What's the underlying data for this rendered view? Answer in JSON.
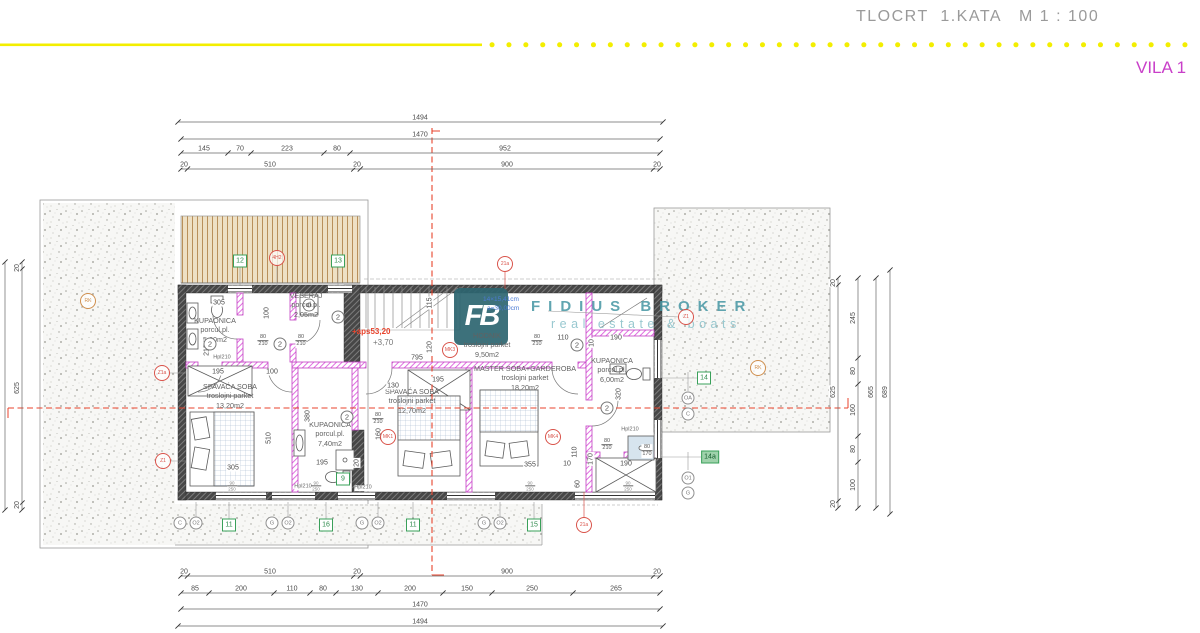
{
  "header": {
    "title": "TLOCRT  1.KATA   M 1 : 100",
    "vila": "VILA 1"
  },
  "colors": {
    "accent_yellow": "#f3ee00",
    "vila_magenta": "#c93fc9",
    "centerline_red": "#e8432c",
    "logo_teal": "#2d6570",
    "brand_teal": "#4596a3",
    "tagline_teal": "#94c6ce",
    "mark_green": "#3aa05a",
    "mark_red": "#d9534a",
    "mark_orange": "#cf8f4e",
    "wall_magenta": "#c23fc2",
    "stair_blue": "#4a7ad4",
    "title_gray": "#9a9a9a"
  },
  "watermark": {
    "logo": "FB",
    "brand": "FIDIUS BROKER",
    "tagline": "real estate & boats"
  },
  "plan": {
    "levels": {
      "abs": "+aps53,20",
      "rel": "+3,70"
    },
    "stairs": {
      "riser": "14×15,41cm",
      "tread": "a=30,00cm"
    },
    "rooms": [
      {
        "name": "KUPAONICA",
        "finish": "porcul.pl.",
        "area": "5,30m2",
        "x": 215,
        "y": 316
      },
      {
        "name": "VEŠERAJ",
        "finish": "porcul.pl.",
        "area": "2,05m2",
        "x": 306,
        "y": 291
      },
      {
        "name": "HODNIK",
        "finish": "troslojni parket",
        "area": "9,50m2",
        "x": 487,
        "y": 331
      },
      {
        "name": "MASTER SOBA+GARDEROBA",
        "finish": "troslojni parket",
        "area": "18,20m2",
        "x": 525,
        "y": 364
      },
      {
        "name": "SPAVAĆA SOBA",
        "finish": "troslojni parket",
        "area": "13,20m2",
        "x": 230,
        "y": 382
      },
      {
        "name": "SPAVAĆA SOBA",
        "finish": "troslojni parket",
        "area": "12,70m2",
        "x": 412,
        "y": 387
      },
      {
        "name": "KUPAONICA",
        "finish": "porcul.pl.",
        "area": "7,40m2",
        "x": 330,
        "y": 420
      },
      {
        "name": "KUPAONICA",
        "finish": "porcul.pl.",
        "area": "6,00m2",
        "x": 612,
        "y": 356
      }
    ],
    "hdims": [
      {
        "y": 122,
        "x1": 178,
        "x2": 663,
        "ticks": [
          178,
          663
        ],
        "labels": [
          {
            "t": "1494",
            "x": 420
          }
        ]
      },
      {
        "y": 139,
        "x1": 181,
        "x2": 660,
        "ticks": [
          181,
          660
        ],
        "labels": [
          {
            "t": "1470",
            "x": 420
          }
        ]
      },
      {
        "y": 153,
        "x1": 181,
        "x2": 660,
        "ticks": [
          181,
          228,
          251,
          324,
          350,
          660
        ],
        "labels": [
          {
            "t": "145",
            "x": 204
          },
          {
            "t": "70",
            "x": 240
          },
          {
            "t": "223",
            "x": 287
          },
          {
            "t": "80",
            "x": 337
          },
          {
            "t": "952",
            "x": 505
          }
        ]
      },
      {
        "y": 169,
        "x1": 181,
        "x2": 660,
        "ticks": [
          181,
          187.5,
          353.8,
          360.3,
          653.5,
          660
        ],
        "labels": [
          {
            "t": "20",
            "x": 184
          },
          {
            "t": "510",
            "x": 270
          },
          {
            "t": "20",
            "x": 357
          },
          {
            "t": "900",
            "x": 507
          },
          {
            "t": "20",
            "x": 657
          }
        ]
      },
      {
        "y": 576,
        "x1": 181,
        "x2": 660,
        "ticks": [
          181,
          187.5,
          353.8,
          360.3,
          653.5,
          660
        ],
        "labels": [
          {
            "t": "20",
            "x": 184
          },
          {
            "t": "510",
            "x": 270
          },
          {
            "t": "20",
            "x": 357
          },
          {
            "t": "900",
            "x": 507
          },
          {
            "t": "20",
            "x": 657
          }
        ]
      },
      {
        "y": 593,
        "x1": 181,
        "x2": 660,
        "ticks": [
          181,
          209,
          274,
          310,
          336,
          378,
          443,
          492,
          573,
          660
        ],
        "labels": [
          {
            "t": "85",
            "x": 195
          },
          {
            "t": "200",
            "x": 241
          },
          {
            "t": "110",
            "x": 292
          },
          {
            "t": "80",
            "x": 323
          },
          {
            "t": "130",
            "x": 357
          },
          {
            "t": "200",
            "x": 410
          },
          {
            "t": "150",
            "x": 467
          },
          {
            "t": "250",
            "x": 532
          },
          {
            "t": "265",
            "x": 616
          }
        ]
      },
      {
        "y": 609,
        "x1": 181,
        "x2": 660,
        "ticks": [
          181,
          660
        ],
        "labels": [
          {
            "t": "1470",
            "x": 420
          }
        ]
      },
      {
        "y": 626,
        "x1": 178,
        "x2": 663,
        "ticks": [
          178,
          663
        ],
        "labels": [
          {
            "t": "1494",
            "x": 420
          }
        ]
      }
    ],
    "vdims": [
      {
        "x": 5,
        "y1": 262,
        "y2": 510,
        "ticks": [
          262,
          510
        ],
        "labels": []
      },
      {
        "x": 22,
        "y1": 262,
        "y2": 510,
        "ticks": [
          262,
          269,
          503,
          510
        ],
        "labels": [
          {
            "t": "20",
            "y": 268
          },
          {
            "t": "625",
            "y": 388
          },
          {
            "t": "20",
            "y": 505
          }
        ]
      },
      {
        "x": 838,
        "y1": 278,
        "y2": 508,
        "ticks": [
          278,
          285,
          501,
          508
        ],
        "labels": [
          {
            "t": "20",
            "y": 283
          },
          {
            "t": "625",
            "y": 392
          },
          {
            "t": "20",
            "y": 504
          }
        ]
      },
      {
        "x": 858,
        "y1": 278,
        "y2": 508,
        "ticks": [
          278,
          358,
          384,
          436,
          462,
          508
        ],
        "labels": [
          {
            "t": "245",
            "y": 318
          },
          {
            "t": "80",
            "y": 371
          },
          {
            "t": "160",
            "y": 410
          },
          {
            "t": "80",
            "y": 449
          },
          {
            "t": "100",
            "y": 485
          }
        ]
      },
      {
        "x": 876,
        "y1": 278,
        "y2": 508,
        "ticks": [
          278,
          508
        ],
        "labels": [
          {
            "t": "665",
            "y": 392
          }
        ]
      },
      {
        "x": 890,
        "y1": 270,
        "y2": 514,
        "ticks": [
          270,
          514
        ],
        "labels": [
          {
            "t": "689",
            "y": 392
          }
        ]
      }
    ],
    "texts": [
      {
        "t": "305",
        "x": 219,
        "y": 303
      },
      {
        "t": "100",
        "x": 267,
        "y": 313,
        "r": 1
      },
      {
        "t": "215",
        "x": 207,
        "y": 350,
        "r": 1
      },
      {
        "t": "195",
        "x": 218,
        "y": 372
      },
      {
        "t": "100",
        "x": 272,
        "y": 372
      },
      {
        "t": "795",
        "x": 417,
        "y": 358
      },
      {
        "t": "115",
        "x": 430,
        "y": 303,
        "r": 1
      },
      {
        "t": "120",
        "x": 430,
        "y": 347,
        "r": 1
      },
      {
        "t": "130",
        "x": 393,
        "y": 386
      },
      {
        "t": "195",
        "x": 438,
        "y": 380
      },
      {
        "t": "380",
        "x": 308,
        "y": 416,
        "r": 1
      },
      {
        "t": "510",
        "x": 269,
        "y": 438,
        "r": 1
      },
      {
        "t": "160",
        "x": 379,
        "y": 434,
        "r": 1
      },
      {
        "t": "305",
        "x": 233,
        "y": 468
      },
      {
        "t": "195",
        "x": 322,
        "y": 463
      },
      {
        "t": "20",
        "x": 357,
        "y": 463,
        "r": 1
      },
      {
        "t": "355",
        "x": 530,
        "y": 465
      },
      {
        "t": "110",
        "x": 575,
        "y": 452,
        "r": 1
      },
      {
        "t": "110",
        "x": 563,
        "y": 338
      },
      {
        "t": "190",
        "x": 616,
        "y": 338
      },
      {
        "t": "320",
        "x": 619,
        "y": 394,
        "r": 1
      },
      {
        "t": "170",
        "x": 591,
        "y": 459,
        "r": 1
      },
      {
        "t": "190",
        "x": 626,
        "y": 464
      },
      {
        "t": "10",
        "x": 567,
        "y": 464
      },
      {
        "t": "60",
        "x": 578,
        "y": 484,
        "r": 1
      },
      {
        "t": "10",
        "x": 592,
        "y": 343,
        "r": 1
      }
    ],
    "fracs": [
      {
        "t": "80/210",
        "x": 263,
        "y": 341
      },
      {
        "t": "80/210",
        "x": 301,
        "y": 341
      },
      {
        "t": "80/210",
        "x": 537,
        "y": 341
      },
      {
        "t": "80/210",
        "x": 378,
        "y": 419
      },
      {
        "t": "80/210",
        "x": 607,
        "y": 445
      },
      {
        "t": "80/170",
        "x": 647,
        "y": 451
      },
      {
        "t": "90/250",
        "x": 232,
        "y": 486,
        "s": 1
      },
      {
        "t": "90/250",
        "x": 316,
        "y": 486,
        "s": 1
      },
      {
        "t": "90/250",
        "x": 530,
        "y": 486,
        "s": 1
      },
      {
        "t": "90/250",
        "x": 628,
        "y": 486,
        "s": 1
      }
    ],
    "lintels": [
      {
        "t": "Hpl210",
        "x": 222,
        "y": 358
      },
      {
        "t": "Hpl210",
        "x": 303,
        "y": 487
      },
      {
        "t": "Hpl210",
        "x": 363,
        "y": 488
      },
      {
        "t": "Hpl210",
        "x": 630,
        "y": 430
      }
    ],
    "green_marks": [
      {
        "t": "12",
        "x": 240,
        "y": 261
      },
      {
        "t": "13",
        "x": 338,
        "y": 261
      },
      {
        "t": "11",
        "x": 229,
        "y": 525
      },
      {
        "t": "16",
        "x": 326,
        "y": 525
      },
      {
        "t": "11",
        "x": 413,
        "y": 525
      },
      {
        "t": "15",
        "x": 534,
        "y": 525
      },
      {
        "t": "9",
        "x": 343,
        "y": 479
      },
      {
        "t": "14",
        "x": 704,
        "y": 378
      },
      {
        "t": "14a",
        "x": 710,
        "y": 457,
        "f": 1
      }
    ],
    "red_marks": [
      {
        "t": "4H2",
        "x": 277,
        "y": 258
      },
      {
        "t": "21a",
        "x": 505,
        "y": 264
      },
      {
        "t": "21a",
        "x": 584,
        "y": 525
      },
      {
        "t": "Z1a",
        "x": 162,
        "y": 373
      },
      {
        "t": "Z1",
        "x": 163,
        "y": 461
      },
      {
        "t": "Z1",
        "x": 686,
        "y": 317
      },
      {
        "t": "MK3",
        "x": 450,
        "y": 350
      },
      {
        "t": "MK1",
        "x": 388,
        "y": 437
      },
      {
        "t": "MK4",
        "x": 553,
        "y": 437
      },
      {
        "t": "RK",
        "x": 88,
        "y": 301,
        "o": 1
      },
      {
        "t": "RK",
        "x": 758,
        "y": 368,
        "o": 1
      }
    ],
    "gray_marks": [
      {
        "t": "C",
        "x": 180,
        "y": 523
      },
      {
        "t": "O2",
        "x": 196,
        "y": 523
      },
      {
        "t": "G",
        "x": 272,
        "y": 523
      },
      {
        "t": "O2",
        "x": 288,
        "y": 523
      },
      {
        "t": "G",
        "x": 362,
        "y": 523
      },
      {
        "t": "O2",
        "x": 378,
        "y": 523
      },
      {
        "t": "G",
        "x": 484,
        "y": 523
      },
      {
        "t": "O2",
        "x": 500,
        "y": 523
      },
      {
        "t": "OA",
        "x": 688,
        "y": 398
      },
      {
        "t": "C",
        "x": 688,
        "y": 414
      },
      {
        "t": "O1",
        "x": 688,
        "y": 478
      },
      {
        "t": "G",
        "x": 688,
        "y": 493
      }
    ],
    "door_marks": [
      {
        "t": "2",
        "x": 210,
        "y": 344
      },
      {
        "t": "2",
        "x": 280,
        "y": 344
      },
      {
        "t": "2",
        "x": 338,
        "y": 317
      },
      {
        "t": "2",
        "x": 347,
        "y": 417
      },
      {
        "t": "2",
        "x": 577,
        "y": 345
      },
      {
        "t": "2",
        "x": 607,
        "y": 408
      }
    ]
  }
}
